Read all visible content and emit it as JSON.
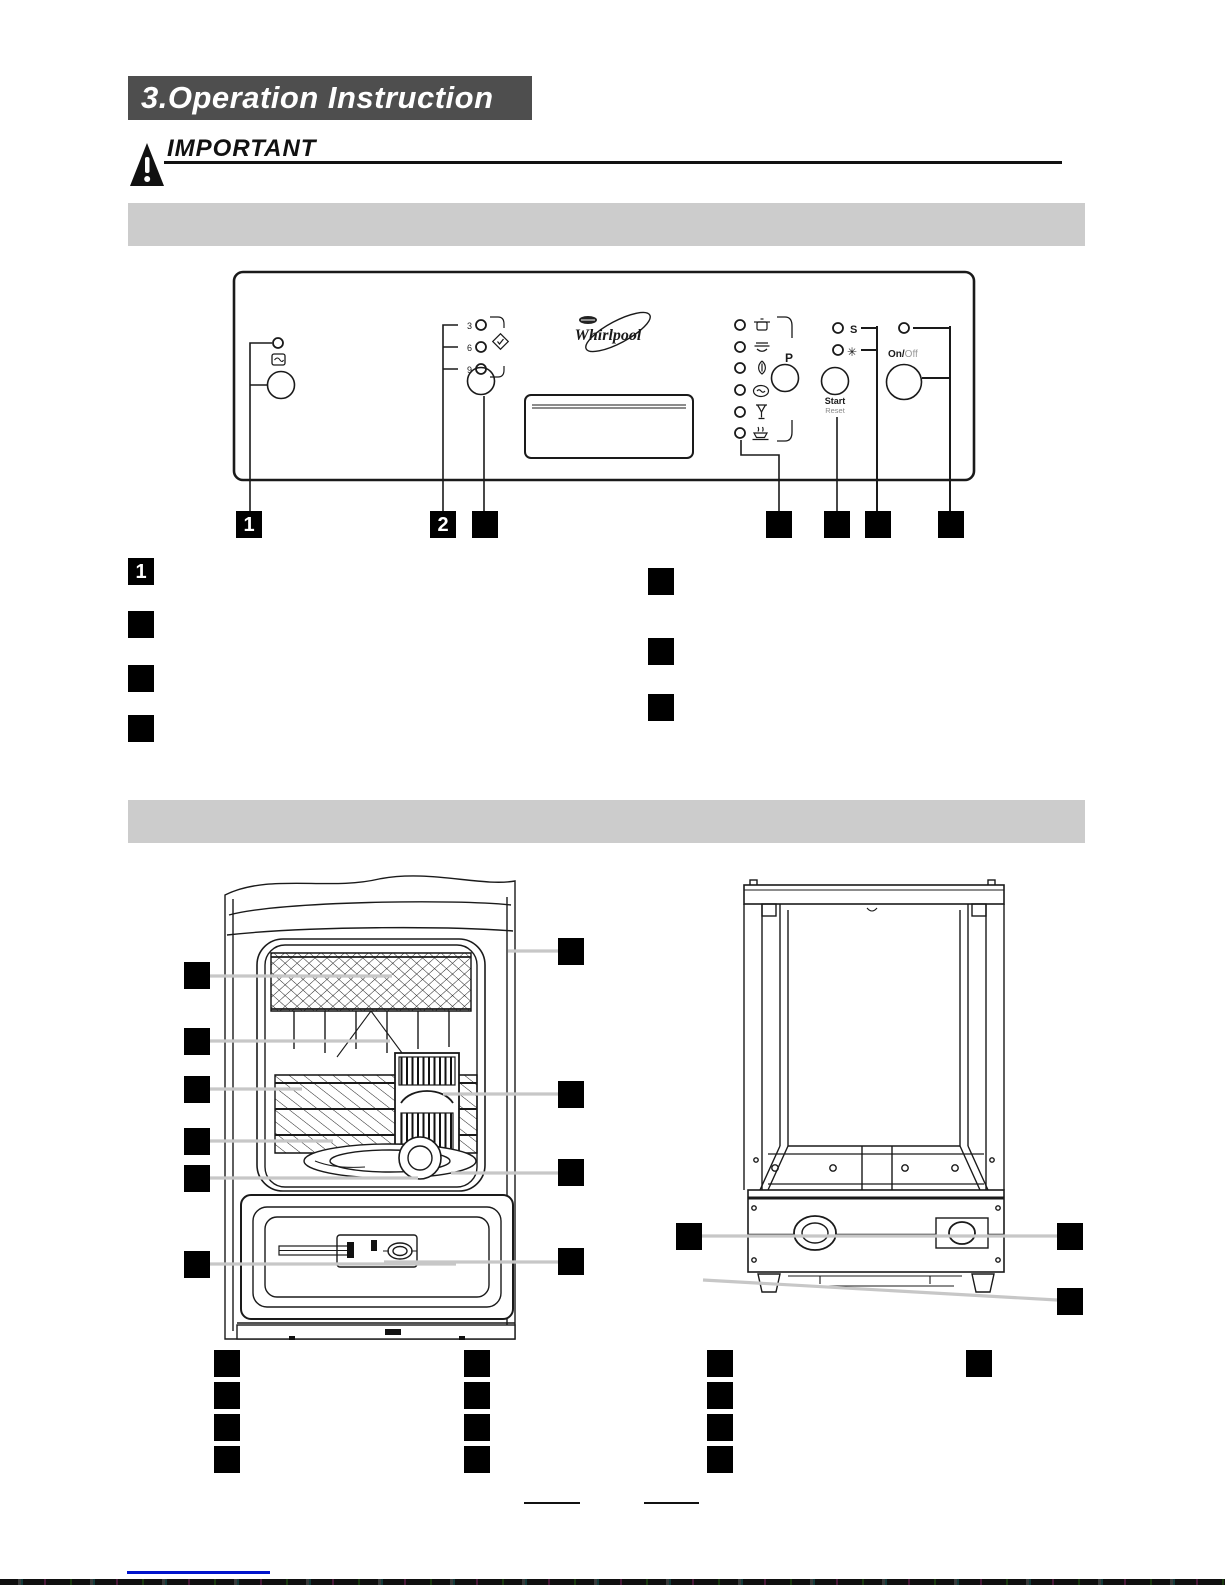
{
  "header": {
    "title": "3.Operation Instruction",
    "important_label": "IMPORTANT"
  },
  "section_bars": {
    "first": "",
    "second": ""
  },
  "control_panel": {
    "brand": "Whirlpool",
    "delay_hours": [
      "3",
      "6",
      "9"
    ],
    "program_selector_label": "P",
    "start_label": "Start",
    "reset_label": "Reset",
    "on_label": "On/",
    "off_label": "Off",
    "salt_symbol": "S",
    "rinse_aid_symbol": "✳",
    "program_icons": [
      "intensive-pot-icon",
      "normal-plates-icon",
      "eco-icon",
      "soak-icon",
      "glass-icon",
      "rapid-icon"
    ],
    "indicators": [
      "salt-refill-indicator",
      "rinse-aid-refill-indicator"
    ],
    "left_button_icon": "half-load-icon",
    "delay_icon": "delay-diamond-check-icon"
  },
  "callouts": {
    "panel_row": [
      {
        "label": "1"
      },
      {
        "label": "2"
      },
      {
        "label": ""
      },
      {
        "label": ""
      },
      {
        "label": ""
      },
      {
        "label": ""
      },
      {
        "label": ""
      }
    ],
    "list_left": [
      {
        "label": "1"
      },
      {
        "label": ""
      },
      {
        "label": ""
      },
      {
        "label": ""
      }
    ],
    "list_right": [
      {
        "label": ""
      },
      {
        "label": ""
      },
      {
        "label": ""
      }
    ],
    "front_view_left": [
      {
        "label": ""
      },
      {
        "label": ""
      },
      {
        "label": ""
      },
      {
        "label": ""
      },
      {
        "label": ""
      },
      {
        "label": ""
      }
    ],
    "front_view_right": [
      {
        "label": ""
      },
      {
        "label": ""
      },
      {
        "label": ""
      },
      {
        "label": ""
      }
    ],
    "rear_view": [
      {
        "label": ""
      },
      {
        "label": ""
      },
      {
        "label": ""
      }
    ],
    "bottom_col1": [
      {
        "label": ""
      },
      {
        "label": ""
      },
      {
        "label": ""
      },
      {
        "label": ""
      }
    ],
    "bottom_col2": [
      {
        "label": ""
      },
      {
        "label": ""
      },
      {
        "label": ""
      },
      {
        "label": ""
      }
    ],
    "bottom_col3": [
      {
        "label": ""
      },
      {
        "label": ""
      },
      {
        "label": ""
      },
      {
        "label": ""
      }
    ],
    "bottom_col4": [
      {
        "label": ""
      }
    ]
  },
  "footer": {
    "blank_line_1": "",
    "blank_line_2": ""
  },
  "colors": {
    "title_bg": "#4e4e4e",
    "title_text": "#ffffff",
    "section_bar": "#cccccc",
    "callout_bg": "#000000",
    "callout_text": "#ffffff",
    "leader_line": "#c7c7c7",
    "drawing_line": "#1a1a1a",
    "link_line": "#0014cc"
  }
}
